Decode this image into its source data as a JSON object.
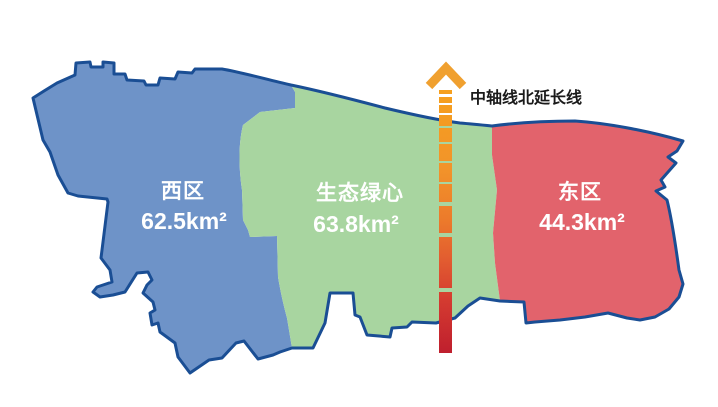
{
  "map": {
    "title": "城市分区示意图",
    "regions": [
      {
        "name": "西区",
        "area": "62.5km²",
        "fill": "#6E93C8"
      },
      {
        "name": "生态绿心",
        "area": "63.8km²",
        "fill": "#A8D5A0"
      },
      {
        "name": "东区",
        "area": "44.3km²",
        "fill": "#E2636C"
      }
    ],
    "axis_line": {
      "label": "中轴线北延长线",
      "arrow_color": "#F0A02F",
      "gradient_top": "#F6A01D",
      "gradient_bottom": "#BF1F2E"
    },
    "outline_color": "#1A4E94",
    "label_color": "#FFFFFF",
    "background": "#FFFFFF"
  }
}
